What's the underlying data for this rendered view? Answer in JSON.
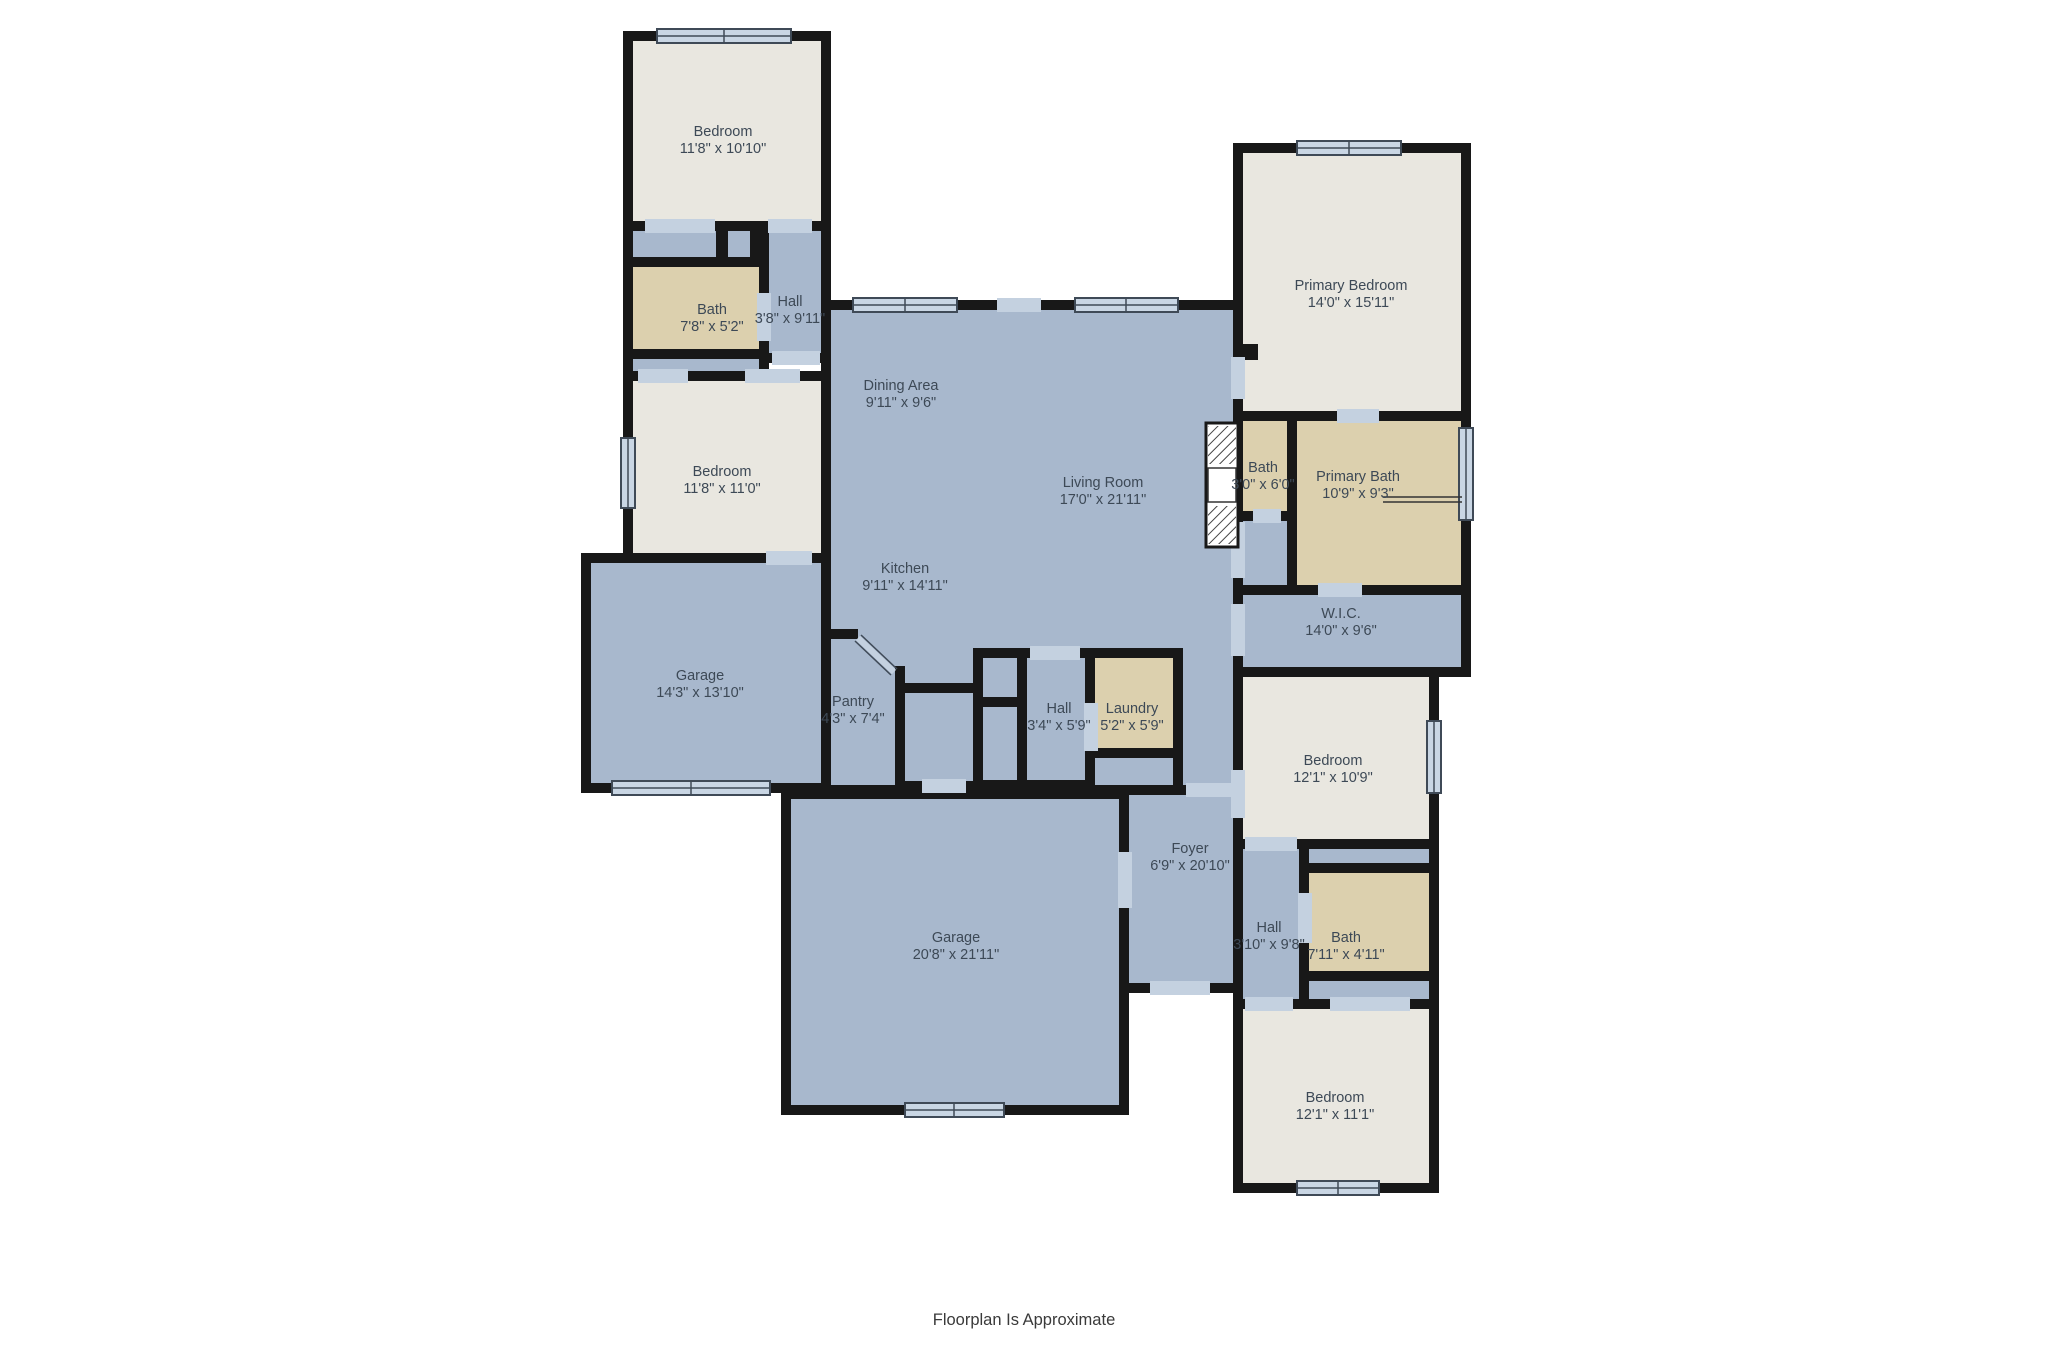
{
  "page": {
    "footer_note": "Floorplan Is Approximate"
  },
  "palette": {
    "floor_blue": "#a8b8cd",
    "room_beige": "#e9e7e0",
    "bath_tan": "#dcd0ae",
    "wall": "#181818",
    "window_fill": "#c9d6e4",
    "door_gap": "#c4d1e0",
    "label_color": "#3d4956"
  },
  "rooms": [
    {
      "name": "Bedroom",
      "dims": "11'8\" x 10'10\""
    },
    {
      "name": "Bath",
      "dims": "7'8\" x 5'2\""
    },
    {
      "name": "Hall",
      "dims": "3'8\" x 9'11\""
    },
    {
      "name": "Bedroom",
      "dims": "11'8\" x 11'0\""
    },
    {
      "name": "Dining Area",
      "dims": "9'11\" x 9'6\""
    },
    {
      "name": "Living Room",
      "dims": "17'0\" x 21'11\""
    },
    {
      "name": "Kitchen",
      "dims": "9'11\" x 14'11\""
    },
    {
      "name": "Garage",
      "dims": "14'3\" x 13'10\""
    },
    {
      "name": "Pantry",
      "dims": "4'3\" x 7'4\""
    },
    {
      "name": "Hall",
      "dims": "3'4\" x 5'9\""
    },
    {
      "name": "Laundry",
      "dims": "5'2\" x 5'9\""
    },
    {
      "name": "Primary Bedroom",
      "dims": "14'0\" x 15'11\""
    },
    {
      "name": "Bath",
      "dims": "3'0\" x 6'0\""
    },
    {
      "name": "Primary Bath",
      "dims": "10'9\" x 9'3\""
    },
    {
      "name": "W.I.C.",
      "dims": "14'0\" x 9'6\""
    },
    {
      "name": "Bedroom",
      "dims": "12'1\" x 10'9\""
    },
    {
      "name": "Foyer",
      "dims": "6'9\" x 20'10\""
    },
    {
      "name": "Garage",
      "dims": "20'8\" x 21'11\""
    },
    {
      "name": "Hall",
      "dims": "3'10\" x 9'8\""
    },
    {
      "name": "Bath",
      "dims": "7'11\" x 4'11\""
    },
    {
      "name": "Bedroom",
      "dims": "12'1\" x 11'1\""
    }
  ]
}
